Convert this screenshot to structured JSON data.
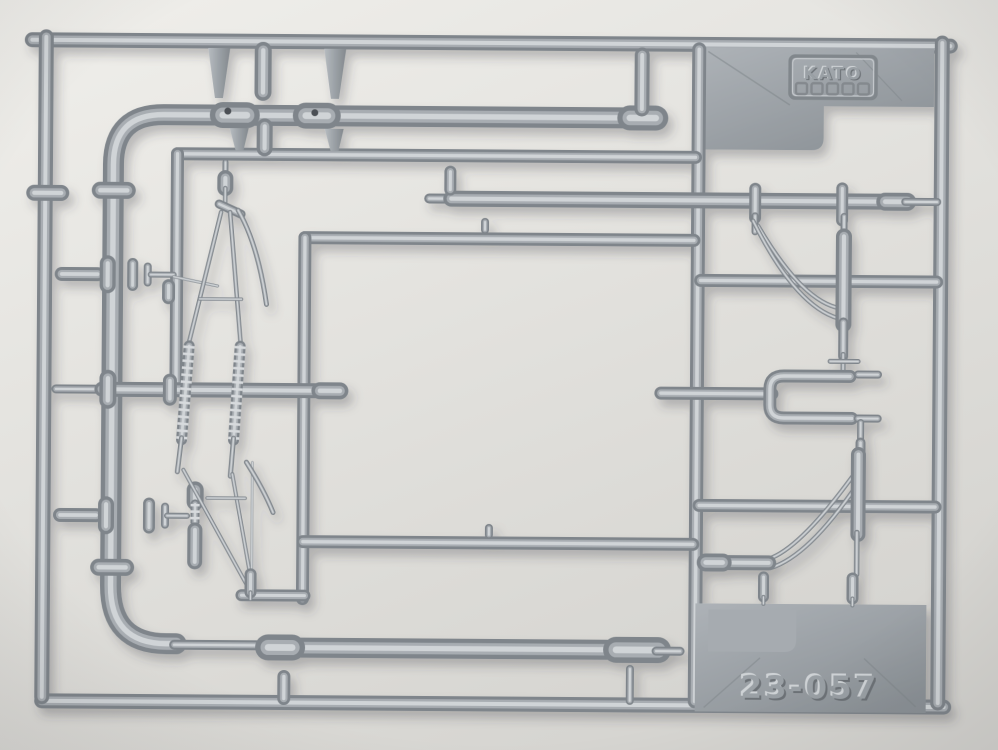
{
  "scene": {
    "type": "photograph",
    "subject": "Gray injection-molded plastic sprue (parts runner) of KATO model catenary pole parts, photographed on a plain light background",
    "background_top_color": "#f0efeb",
    "background_bottom_color": "#d6d5d1",
    "plastic_edge_color": "#7f858b",
    "plastic_mid_color": "#a8adb2",
    "plastic_highlight_color": "#d0d4d7",
    "plate_gradient_light": "#adb2b7",
    "plate_gradient_dark": "#8b9196"
  },
  "markings": {
    "brand": "KATO",
    "part_number": "23-057",
    "logo_mark_count": 5
  }
}
